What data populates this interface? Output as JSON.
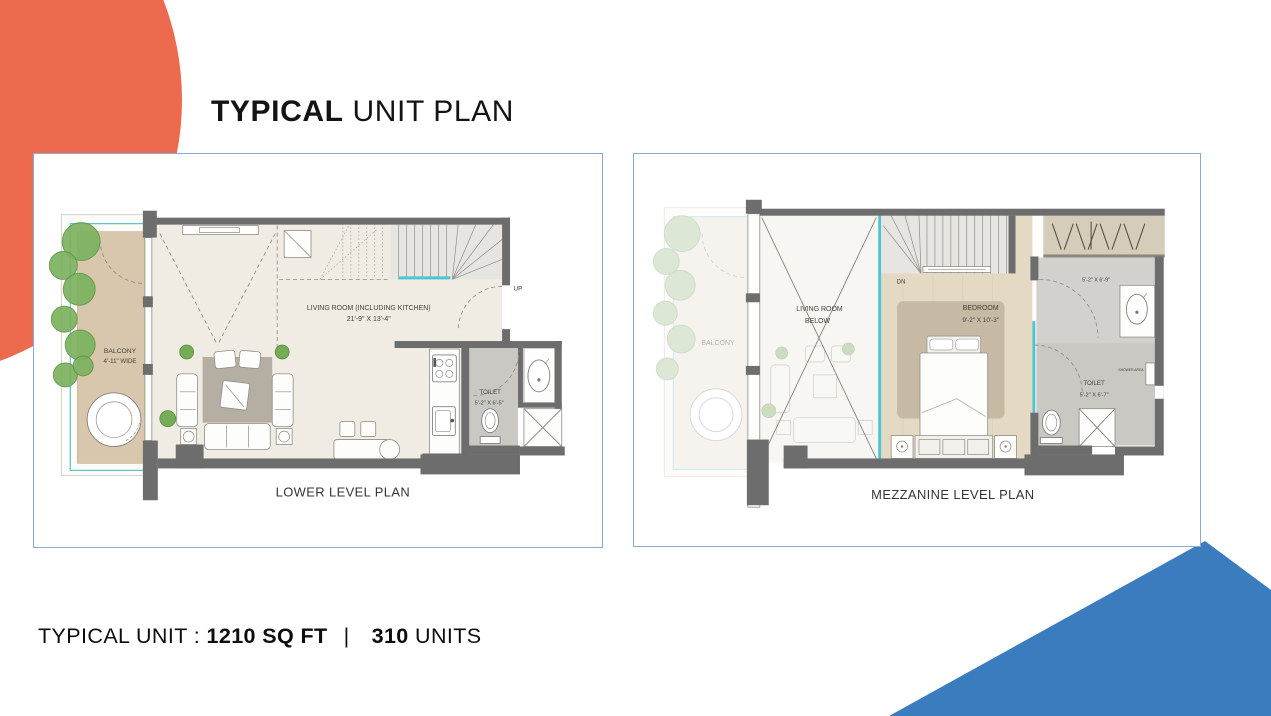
{
  "slide": {
    "title": {
      "emphasis": "TYPICAL",
      "rest": " UNIT PLAN"
    },
    "footer": {
      "label": "TYPICAL UNIT : ",
      "area": "1210 SQ FT",
      "separator": "|",
      "count": "310",
      "units": " UNITS"
    }
  },
  "plans": {
    "lower": {
      "caption": "LOWER LEVEL PLAN",
      "labels": {
        "living_1": "LIVING ROOM (INCLUDING KITCHEN)",
        "living_2": "21'-9\" X 13'-4\"",
        "balcony_1": "BALCONY",
        "balcony_2": "4'-11\" WIDE",
        "toilet_1": "TOILET",
        "toilet_2": "5'-2\" X 6'-5\"",
        "up": "UP"
      }
    },
    "mezzanine": {
      "caption": "MEZZANINE LEVEL PLAN",
      "labels": {
        "balcony": "BALCONY",
        "living_1": "LIVING ROOM",
        "living_2": "BELOW",
        "bedroom_1": "BEDROOM",
        "bedroom_2": "9'-2\" X 10'-3\"",
        "closet_dim": "5'-2\" X 6'-9\"",
        "toilet_1": "TOILET",
        "toilet_2": "5'-2\" X 6'-7\"",
        "shower": "SHOWER AREA",
        "dn": "DN"
      }
    }
  },
  "colors": {
    "accent_orange": "#ED6A4E",
    "accent_blue": "#3A7CBE",
    "frame_border": "#88ABD8",
    "wall": "#6D6D6D",
    "teal": "#4FC3D1"
  }
}
